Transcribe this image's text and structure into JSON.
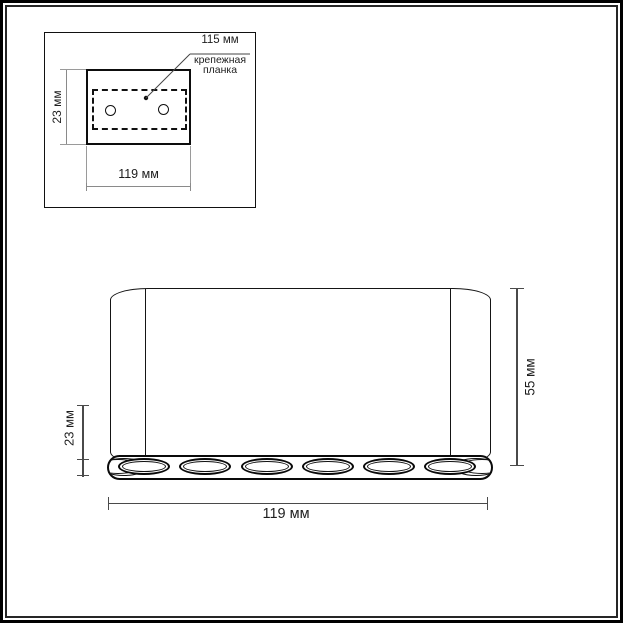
{
  "diagram": {
    "type": "product dimension drawing",
    "units": "мм"
  },
  "colors": {
    "background": "#ffffff",
    "line": "#111111",
    "dim_line": "#4a4a4a",
    "inset_dim_line": "#8a8a8a"
  },
  "top_view": {
    "width_label": "119 мм",
    "height_label": "23 мм",
    "plate_width_label": "115 мм",
    "plate_name_line1": "крепежная",
    "plate_name_line2": "планка",
    "hole_count": 2
  },
  "front_view": {
    "width_label": "119 мм",
    "strip_height_label": "23 мм",
    "total_height_label": "55 мм",
    "led_count": 6
  }
}
